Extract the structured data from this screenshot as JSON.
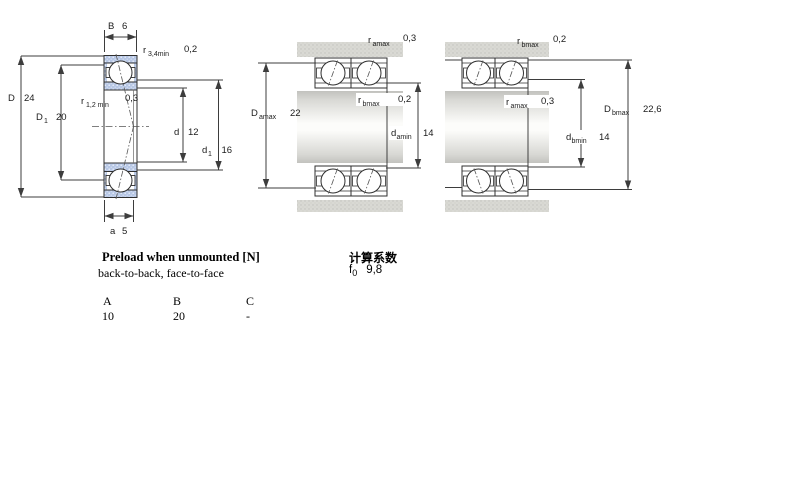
{
  "colors": {
    "ring_fill": "#b7c7e5",
    "housing_fill": "#d9d9d4",
    "line": "#3d3d3d"
  },
  "diagram_single": {
    "B": {
      "sym": "B",
      "value": "6"
    },
    "r34": {
      "sym": "r",
      "sub": "3,4min",
      "value": "0,2"
    },
    "D": {
      "sym": "D",
      "value": "24"
    },
    "D1": {
      "sym": "D",
      "sub": "1",
      "value": "20"
    },
    "r12": {
      "sym": "r",
      "sub": "1,2 min",
      "value": "0,3"
    },
    "d": {
      "sym": "d",
      "value": "12"
    },
    "d1": {
      "sym": "d",
      "sub": "1",
      "value": "16"
    },
    "a": {
      "sym": "a",
      "value": "5"
    }
  },
  "diagram_pair_left": {
    "ra": {
      "sym": "r",
      "sub": "amax",
      "value": "0,3"
    },
    "Da": {
      "sym": "D",
      "sub": "amax",
      "value": "22"
    },
    "rb": {
      "sym": "r",
      "sub": "bmax",
      "value": "0,2"
    },
    "da": {
      "sym": "d",
      "sub": "amin",
      "value": "14"
    }
  },
  "diagram_pair_right": {
    "rb": {
      "sym": "r",
      "sub": "bmax",
      "value": "0,2"
    },
    "ra": {
      "sym": "r",
      "sub": "amax",
      "value": "0,3"
    },
    "Db": {
      "sym": "D",
      "sub": "bmax",
      "value": "22,6"
    },
    "db": {
      "sym": "d",
      "sub": "bmin",
      "value": "14"
    }
  },
  "preload": {
    "title": "Preload when unmounted [N]",
    "subtitle": "back-to-back, face-to-face",
    "col_headers": [
      "A",
      "B",
      "C"
    ],
    "col_values": [
      "10",
      "20",
      "-"
    ]
  },
  "calculation": {
    "title": "计算系数",
    "factor_sym": "f",
    "factor_sub": "0",
    "factor_value": "9,8"
  }
}
